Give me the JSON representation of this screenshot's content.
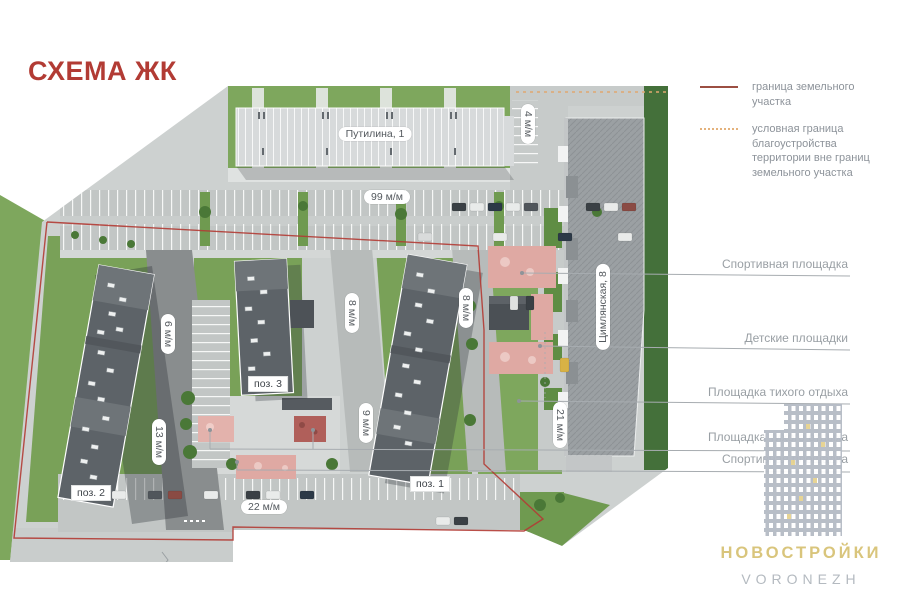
{
  "title": "СХЕМА ЖК",
  "legend": {
    "solid_label": "граница земельного участка",
    "dotted_label": "условная граница благоустройства территории вне границ земельного участка",
    "solid_color": "#9c4f42",
    "dotted_color": "#e4b27c"
  },
  "callouts": [
    {
      "label": "Спортивная площадка"
    },
    {
      "label": "Детские площадки"
    },
    {
      "label": "Площадка тихого отдыха"
    },
    {
      "label": "Площадка тихого отдыха"
    },
    {
      "label": "Спортивная площадка"
    }
  ],
  "map": {
    "building_top_label": "Путилина, 1",
    "building_right_label": "Цимлянская, 8",
    "pos_labels": {
      "pos1": "поз. 1",
      "pos2": "поз. 2",
      "pos3": "поз. 3"
    },
    "parking": {
      "p99": "99 м/м",
      "p4": "4 м/м",
      "p6": "6 м/м",
      "p13": "13 м/м",
      "p8a": "8 м/м",
      "p8b": "8 м/м",
      "p9": "9 м/м",
      "p21": "21 м/м",
      "p22": "22 м/м"
    }
  },
  "watermark": {
    "brand": "НОВОСТРОЙКИ",
    "city": "VORONEZH"
  },
  "colors": {
    "title_red": "#b23b34",
    "boundary_red": "#b23b34",
    "callout_gray": "#999fa4",
    "grass": "#79a158",
    "asphalt": "#c2c6c5",
    "dark_roof": "#5d6368",
    "pink_area": "#dfa9a3"
  }
}
